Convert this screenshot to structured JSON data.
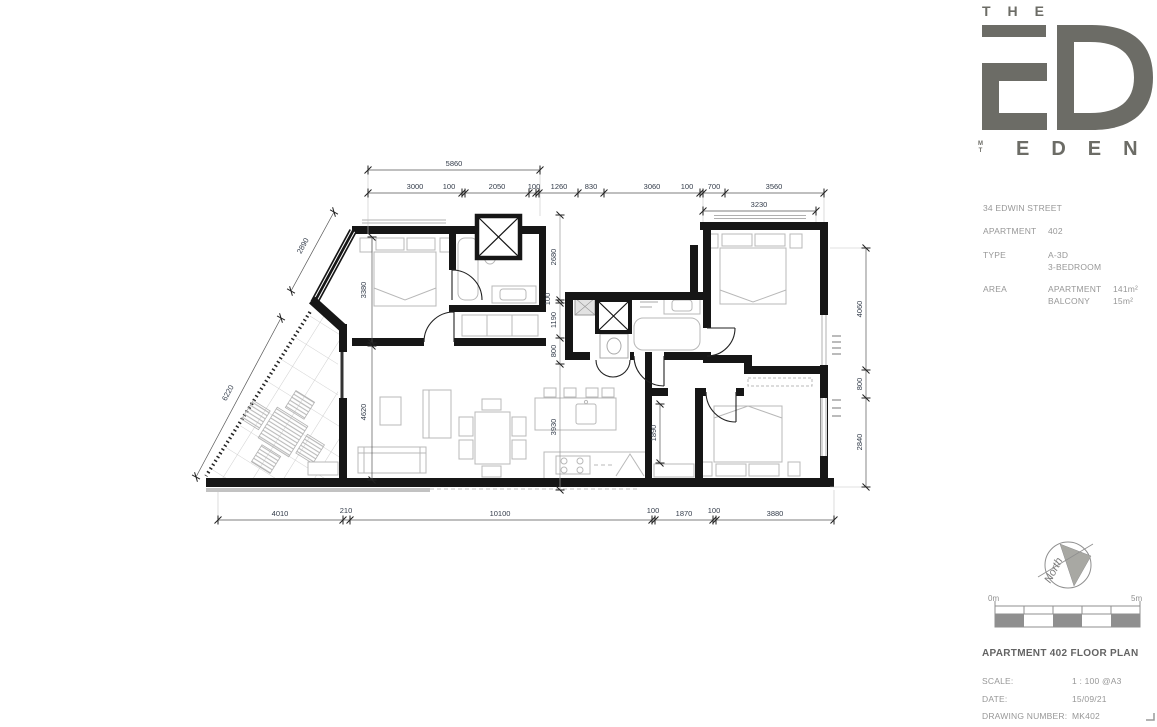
{
  "logo": {
    "the": "THE",
    "eden": "EDEN",
    "mt_m": "M",
    "mt_t": "T"
  },
  "info": {
    "address": "34 EDWIN STREET",
    "apartment_label": "APARTMENT",
    "apartment_value": "402",
    "type_label": "TYPE",
    "type_line1": "A-3D",
    "type_line2": "3-BEDROOM",
    "area_label": "AREA",
    "area_rows": [
      {
        "name": "APARTMENT",
        "value": "141m²"
      },
      {
        "name": "BALCONY",
        "value": "15m²"
      }
    ]
  },
  "titleblock": {
    "title": "APARTMENT 402 FLOOR PLAN",
    "scale_label": "SCALE:",
    "scale_value": "1 : 100 @A3",
    "date_label": "DATE:",
    "date_value": "15/09/21",
    "drawing_label": "DRAWING NUMBER:",
    "drawing_value": "MK402"
  },
  "compass": {
    "label": "North"
  },
  "scalebar": {
    "start": "0m",
    "end": "5m"
  },
  "dims": {
    "top_overall": "5860",
    "top_chain": [
      "3000",
      "100",
      "2050",
      "100",
      "1260",
      "830",
      "3060",
      "100",
      "700",
      "3560"
    ],
    "top_sub": "3230",
    "bottom_chain": [
      "4010",
      "210",
      "10100",
      "100",
      "1870",
      "100",
      "3880"
    ],
    "right_chain": [
      "4060",
      "800",
      "2840"
    ],
    "mid_chain": [
      "2680",
      "100",
      "1190",
      "800",
      "3930"
    ],
    "left_chain": [
      "3380",
      "4620"
    ],
    "diag_upper": "2890",
    "diag_lower": "6220",
    "hall": "1890"
  }
}
